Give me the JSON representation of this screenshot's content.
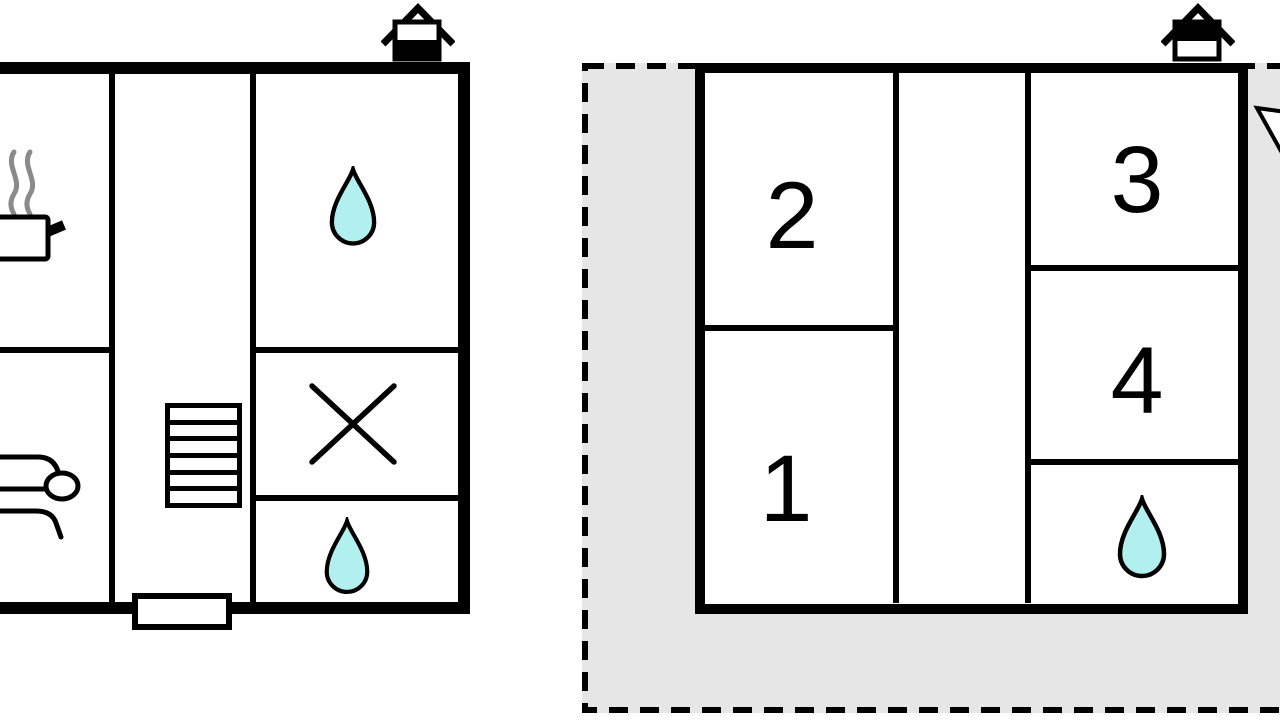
{
  "diagram": {
    "type": "floor-plan",
    "units": {
      "left_unit": {
        "description": "ground-floor unit",
        "icons": {
          "chimney": "chimney-icon",
          "stove": "stove-with-steam-icon",
          "sofa": "sofa-icon",
          "stairs": "staircase-icon",
          "bath_top": "water-drop-icon",
          "cross": "cross-x-icon",
          "bath_bottom": "water-drop-icon",
          "entrance": "entrance-door"
        }
      },
      "right_unit": {
        "description": "upper-floor unit on dashed plot",
        "rooms": {
          "r1": "1",
          "r2": "2",
          "r3": "3",
          "r4": "4"
        },
        "icons": {
          "chimney": "chimney-icon",
          "bath": "water-drop-icon",
          "north_arrow": "north-arrow-partial-icon"
        }
      }
    },
    "colors": {
      "wall": "#000000",
      "terrace": "#e6e6e6",
      "water": "#b2f0f0",
      "steam": "#8a8a8a",
      "background": "#ffffff"
    }
  }
}
